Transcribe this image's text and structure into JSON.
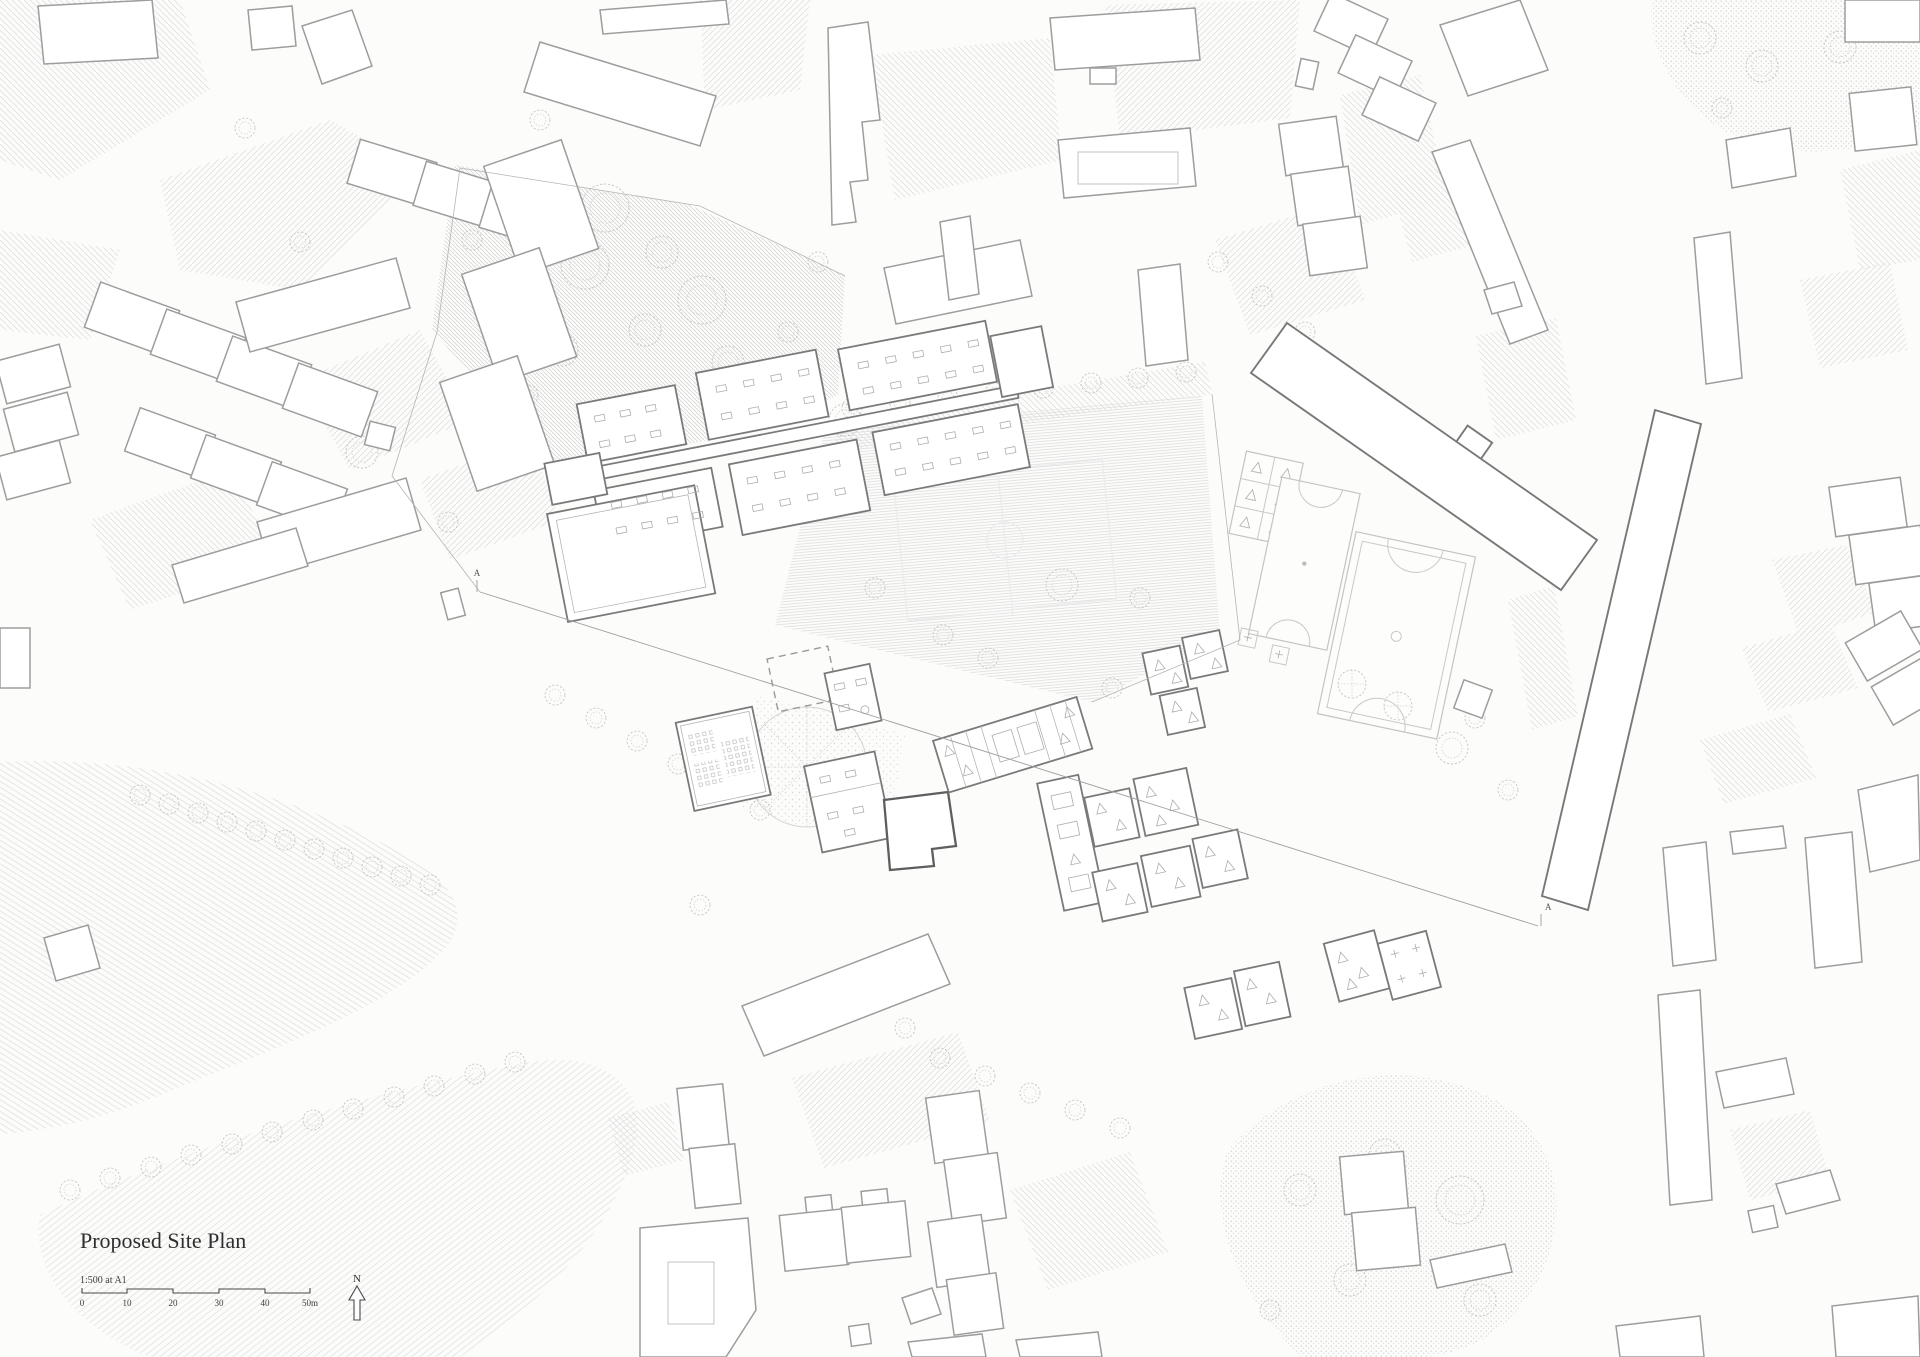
{
  "document": {
    "title": "Proposed Site Plan",
    "scale_note": "1:500 at A1",
    "north_label": "N",
    "scale_bar": {
      "ticks": [
        "0",
        "10",
        "20",
        "30",
        "40",
        "50m"
      ]
    },
    "section_marker_start": "A",
    "section_marker_end": "A"
  },
  "colors": {
    "background": "#fcfcfb",
    "context_building_outline": "#9d9d9d",
    "proposed_building_outline": "#7a7a7a",
    "emphasis_building_outline": "#5e5e5e",
    "hatch_light": "#dfdfdf",
    "hatch_field": "#dadada",
    "tree_outline": "#c6c6c6",
    "text": "#2e2e2e"
  }
}
